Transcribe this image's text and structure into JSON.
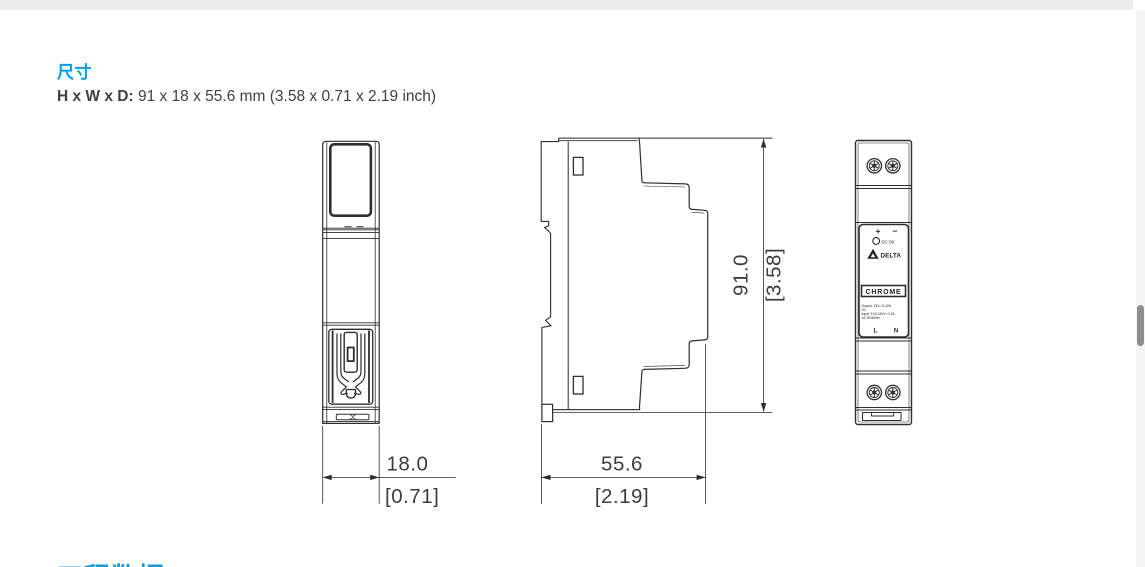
{
  "page": {
    "heading": "尺寸",
    "subheading_label": "H x W x D:",
    "subheading_value": " 91 x 18 x 55.6 mm (3.58 x 0.71 x 2.19 inch)",
    "next_section_heading": "工程数据",
    "accent_color": "#00A0E9"
  },
  "drawings": {
    "front_view": {
      "width_mm": "18.0",
      "width_inch": "[0.71]"
    },
    "side_view": {
      "depth_mm": "55.6",
      "depth_inch": "[2.19]",
      "height_mm": "91.0",
      "height_inch": "[3.58]"
    },
    "panel_view": {
      "plus_label": "+",
      "minus_label": "−",
      "led_label": "DC OK",
      "brand": "DELTA",
      "series": "CHROME",
      "spec_lines": [
        "Output: 24V⎓0.42A",
        "DC",
        "Input: 100-240V~0.3A",
        "AC 50/60Hz"
      ],
      "line_label": "L",
      "neutral_label": "N"
    }
  }
}
